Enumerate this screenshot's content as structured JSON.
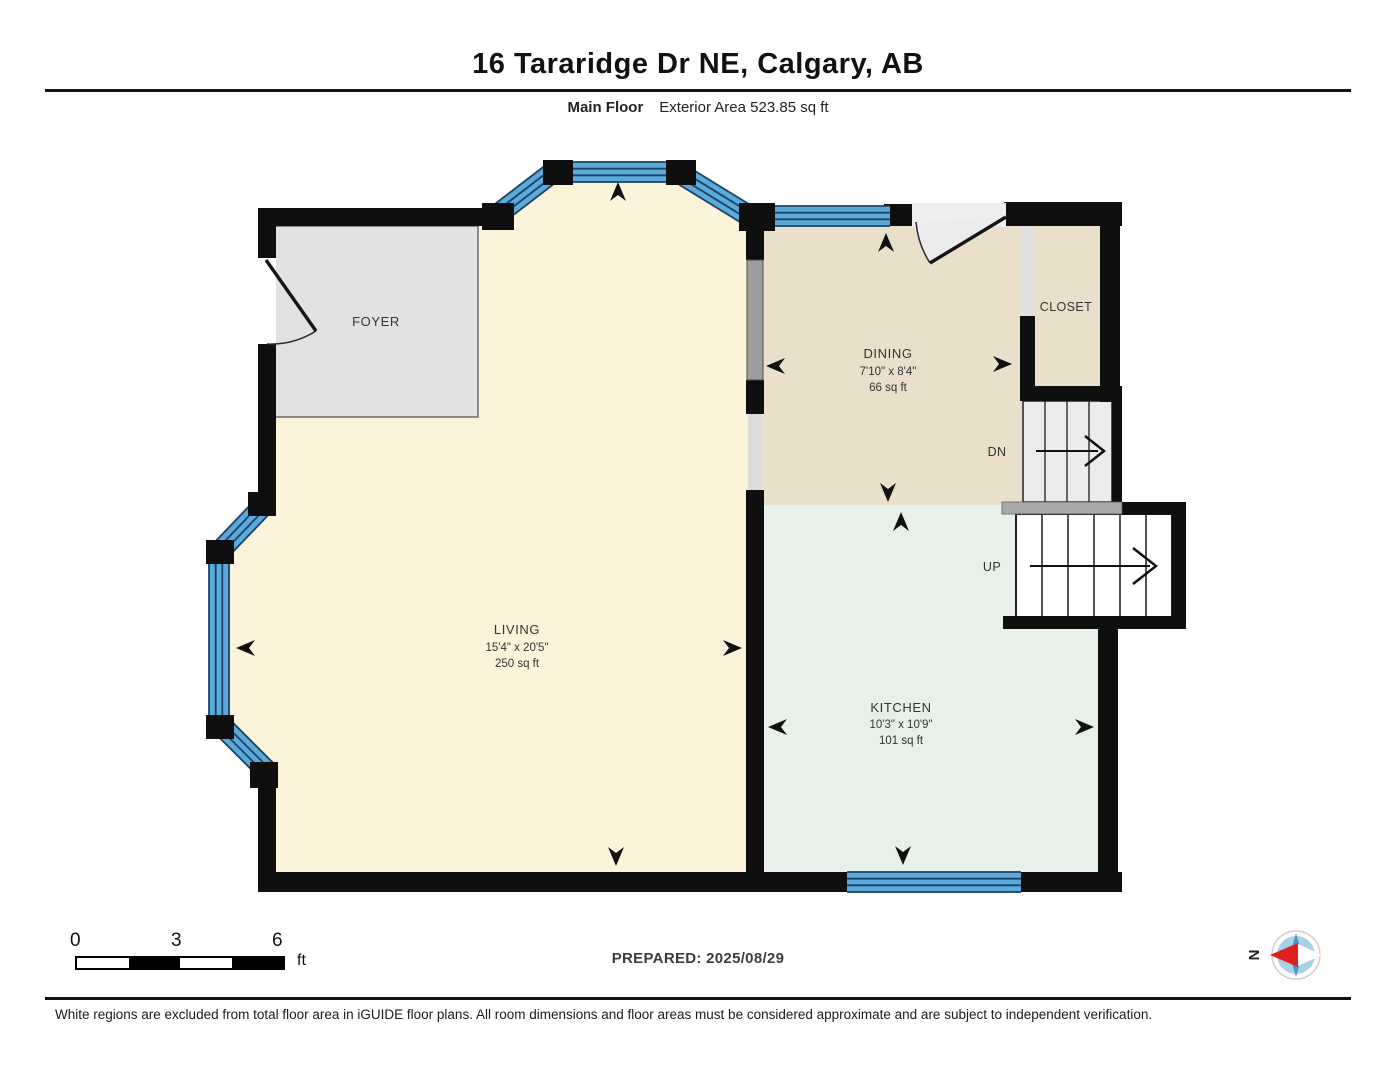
{
  "header": {
    "title": "16 Tararidge Dr NE, Calgary, AB",
    "floor_label": "Main Floor",
    "area_label": "Exterior Area 523.85 sq ft"
  },
  "floorplan": {
    "rooms": [
      {
        "name": "FOYER"
      },
      {
        "name": "DINING",
        "dimensions": "7'10\" x 8'4\"",
        "area": "66 sq ft"
      },
      {
        "name": "LIVING",
        "dimensions": "15'4\" x 20'5\"",
        "area": "250 sq ft"
      },
      {
        "name": "KITCHEN",
        "dimensions": "10'3\" x 10'9\"",
        "area": "101 sq ft"
      },
      {
        "name": "CLOSET"
      }
    ],
    "stairs": {
      "down_label": "DN",
      "up_label": "UP"
    },
    "colors": {
      "wall": "#0f0f0f",
      "window_blue": "#5aaadb",
      "window_stripe": "#1d4163",
      "living_fill": "#fbf4da",
      "dining_fill": "#eadfca",
      "kitchen_fill": "#e7f0e9",
      "foyer_fill": "#e2e2e2",
      "railing_gray": "#9e9e9e",
      "landing_gray": "#a9a9a9"
    }
  },
  "footer": {
    "scale": {
      "ticks": [
        "0",
        "3",
        "6"
      ],
      "unit": "ft"
    },
    "prepared": "PREPARED: 2025/08/29",
    "compass_north": "N",
    "disclaimer": "White regions are excluded from total floor area in iGUIDE floor plans. All room dimensions and floor areas must be considered approximate and are subject to independent verification."
  }
}
